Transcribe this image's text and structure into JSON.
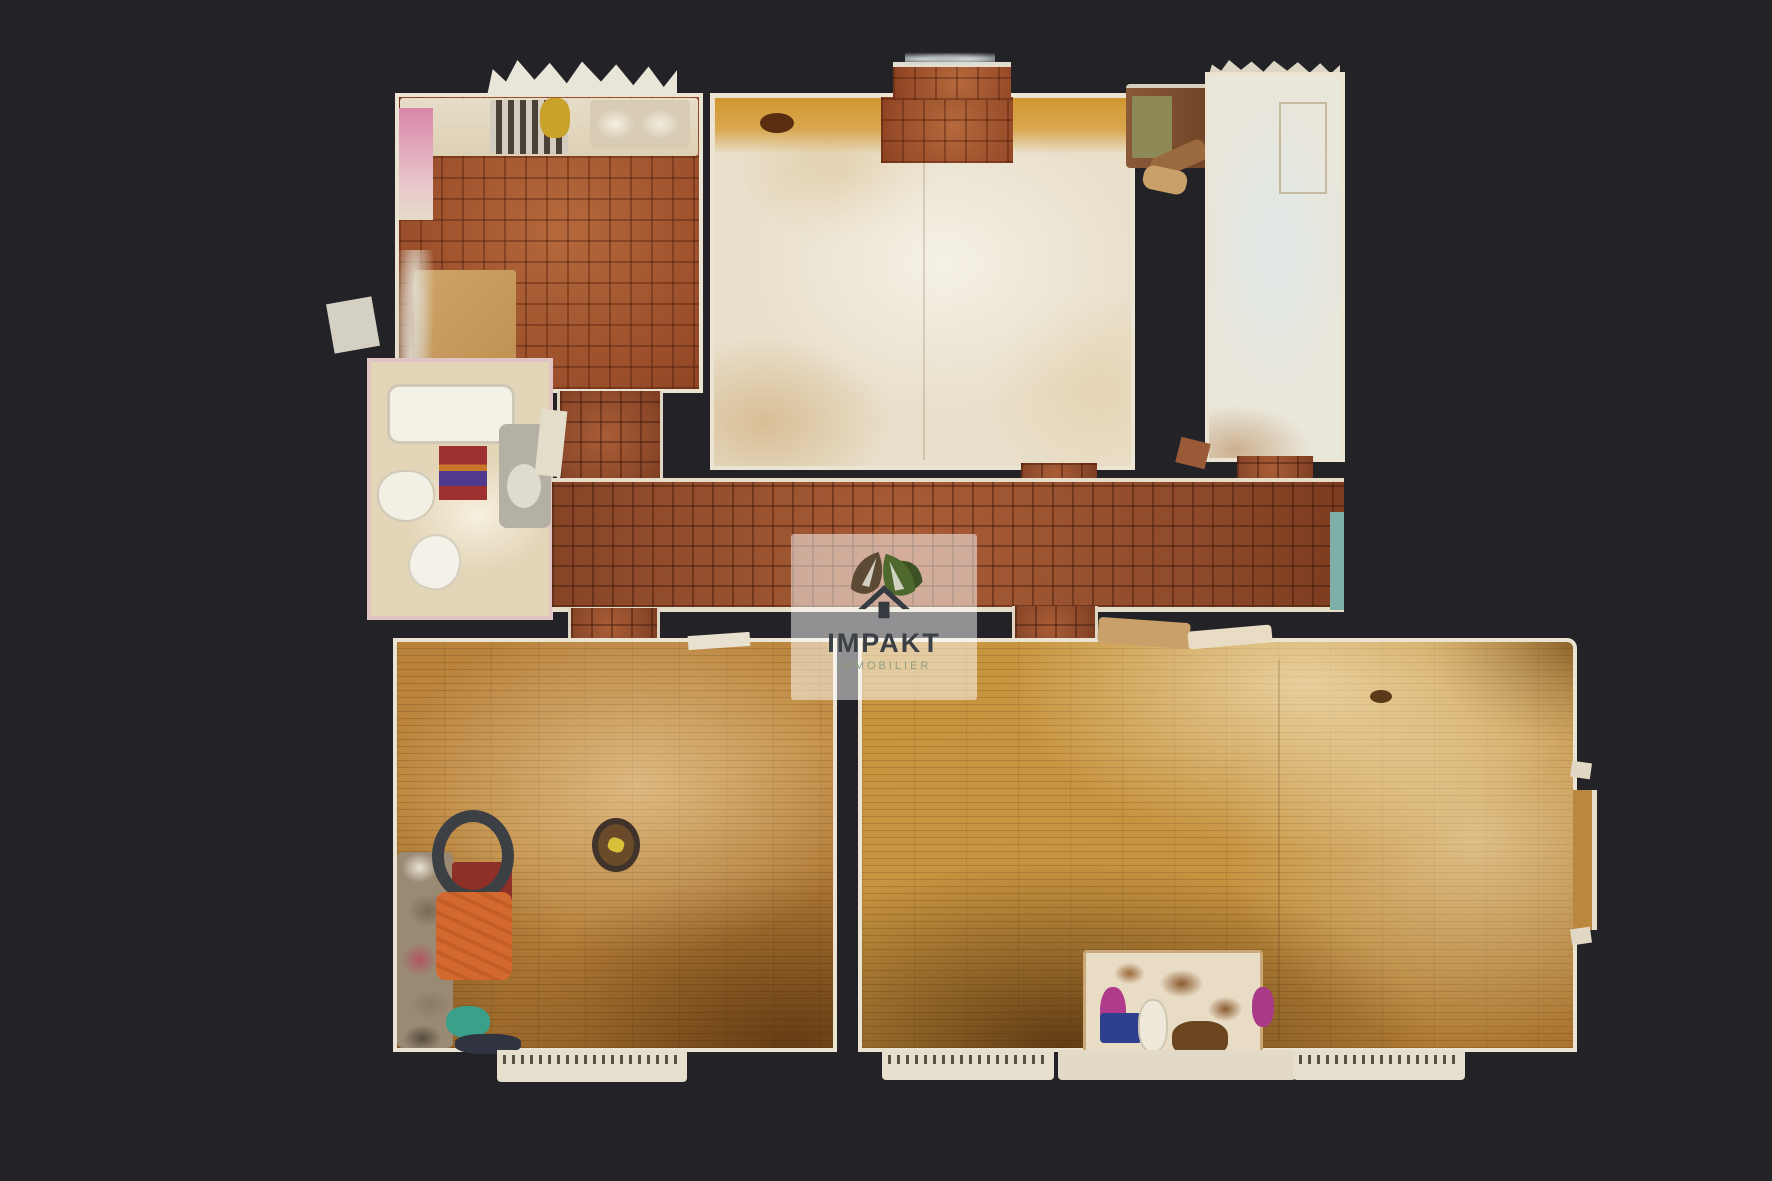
{
  "scene": {
    "description": "Top-down dollhouse 3D scan of an apartment floor plan on dark background",
    "background_color": "#232327",
    "watermark": {
      "brand": "IMPAKT",
      "tagline": "IMMOBILIER",
      "brand_color": "#3a4046",
      "tagline_color": "#8fa080",
      "panel_color": "#ffffff",
      "panel_opacity": 0.5,
      "leaf_left_color": "#5d4a35",
      "leaf_right_color": "#4f682e",
      "leaf_back_color": "#3c5224",
      "house_color": "#343a40"
    },
    "colors": {
      "kitchen_tile": "#9a4e2a",
      "hall_tile": "#8e4a2b",
      "wood_floor_left_room": "#b8823c",
      "wood_floor_right_room": "#c8963f",
      "bedroom_cream_floor": "#e9dfca",
      "bedroom_orange_band": "#d49a3a",
      "narrow_room_floor": "#e9e6da",
      "bathroom_floor": "#e3d5b8",
      "wall": "#ece4d2",
      "rug_red": "#9e3030",
      "rug_purple": "#4f3a8e",
      "armchair_orange": "#d4692f",
      "clutter_teal": "#3aa08a",
      "chair_magenta": "#b03a8c",
      "hall_end_teal": "#7fb0a8"
    },
    "rooms": [
      "kitchen",
      "bedroom",
      "narrow-room",
      "bathroom",
      "hallway",
      "living-room-left",
      "living-room-right"
    ]
  }
}
